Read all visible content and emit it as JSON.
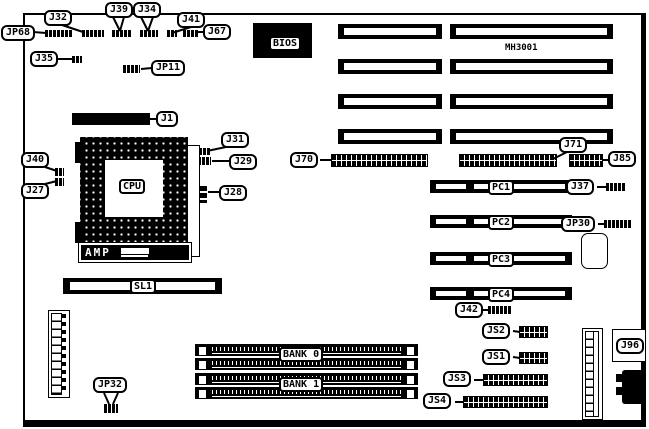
{
  "board": {
    "model": "MH3001"
  },
  "chips": {
    "bios": "BIOS",
    "cpu": "CPU",
    "amp": "AMP"
  },
  "slots": {
    "sl1": "SL1",
    "pc1": "PC1",
    "pc2": "PC2",
    "pc3": "PC3",
    "pc4": "PC4",
    "bank0": "BANK 0",
    "bank1": "BANK 1"
  },
  "callouts": {
    "jp68": "JP68",
    "j32": "J32",
    "j39": "J39",
    "j34": "J34",
    "j41": "J41",
    "j67": "J67",
    "j35": "J35",
    "jp11": "JP11",
    "j1": "J1",
    "j31": "J31",
    "j29": "J29",
    "j28": "J28",
    "j40": "J40",
    "j27": "J27",
    "j70": "J70",
    "j71": "J71",
    "j85": "J85",
    "j37": "J37",
    "jp30": "JP30",
    "j42": "J42",
    "js2": "JS2",
    "js1": "JS1",
    "js3": "JS3",
    "js4": "JS4",
    "jp32": "JP32",
    "j96": "J96"
  },
  "colors": {
    "ink": "#000000",
    "paper": "#ffffff"
  }
}
